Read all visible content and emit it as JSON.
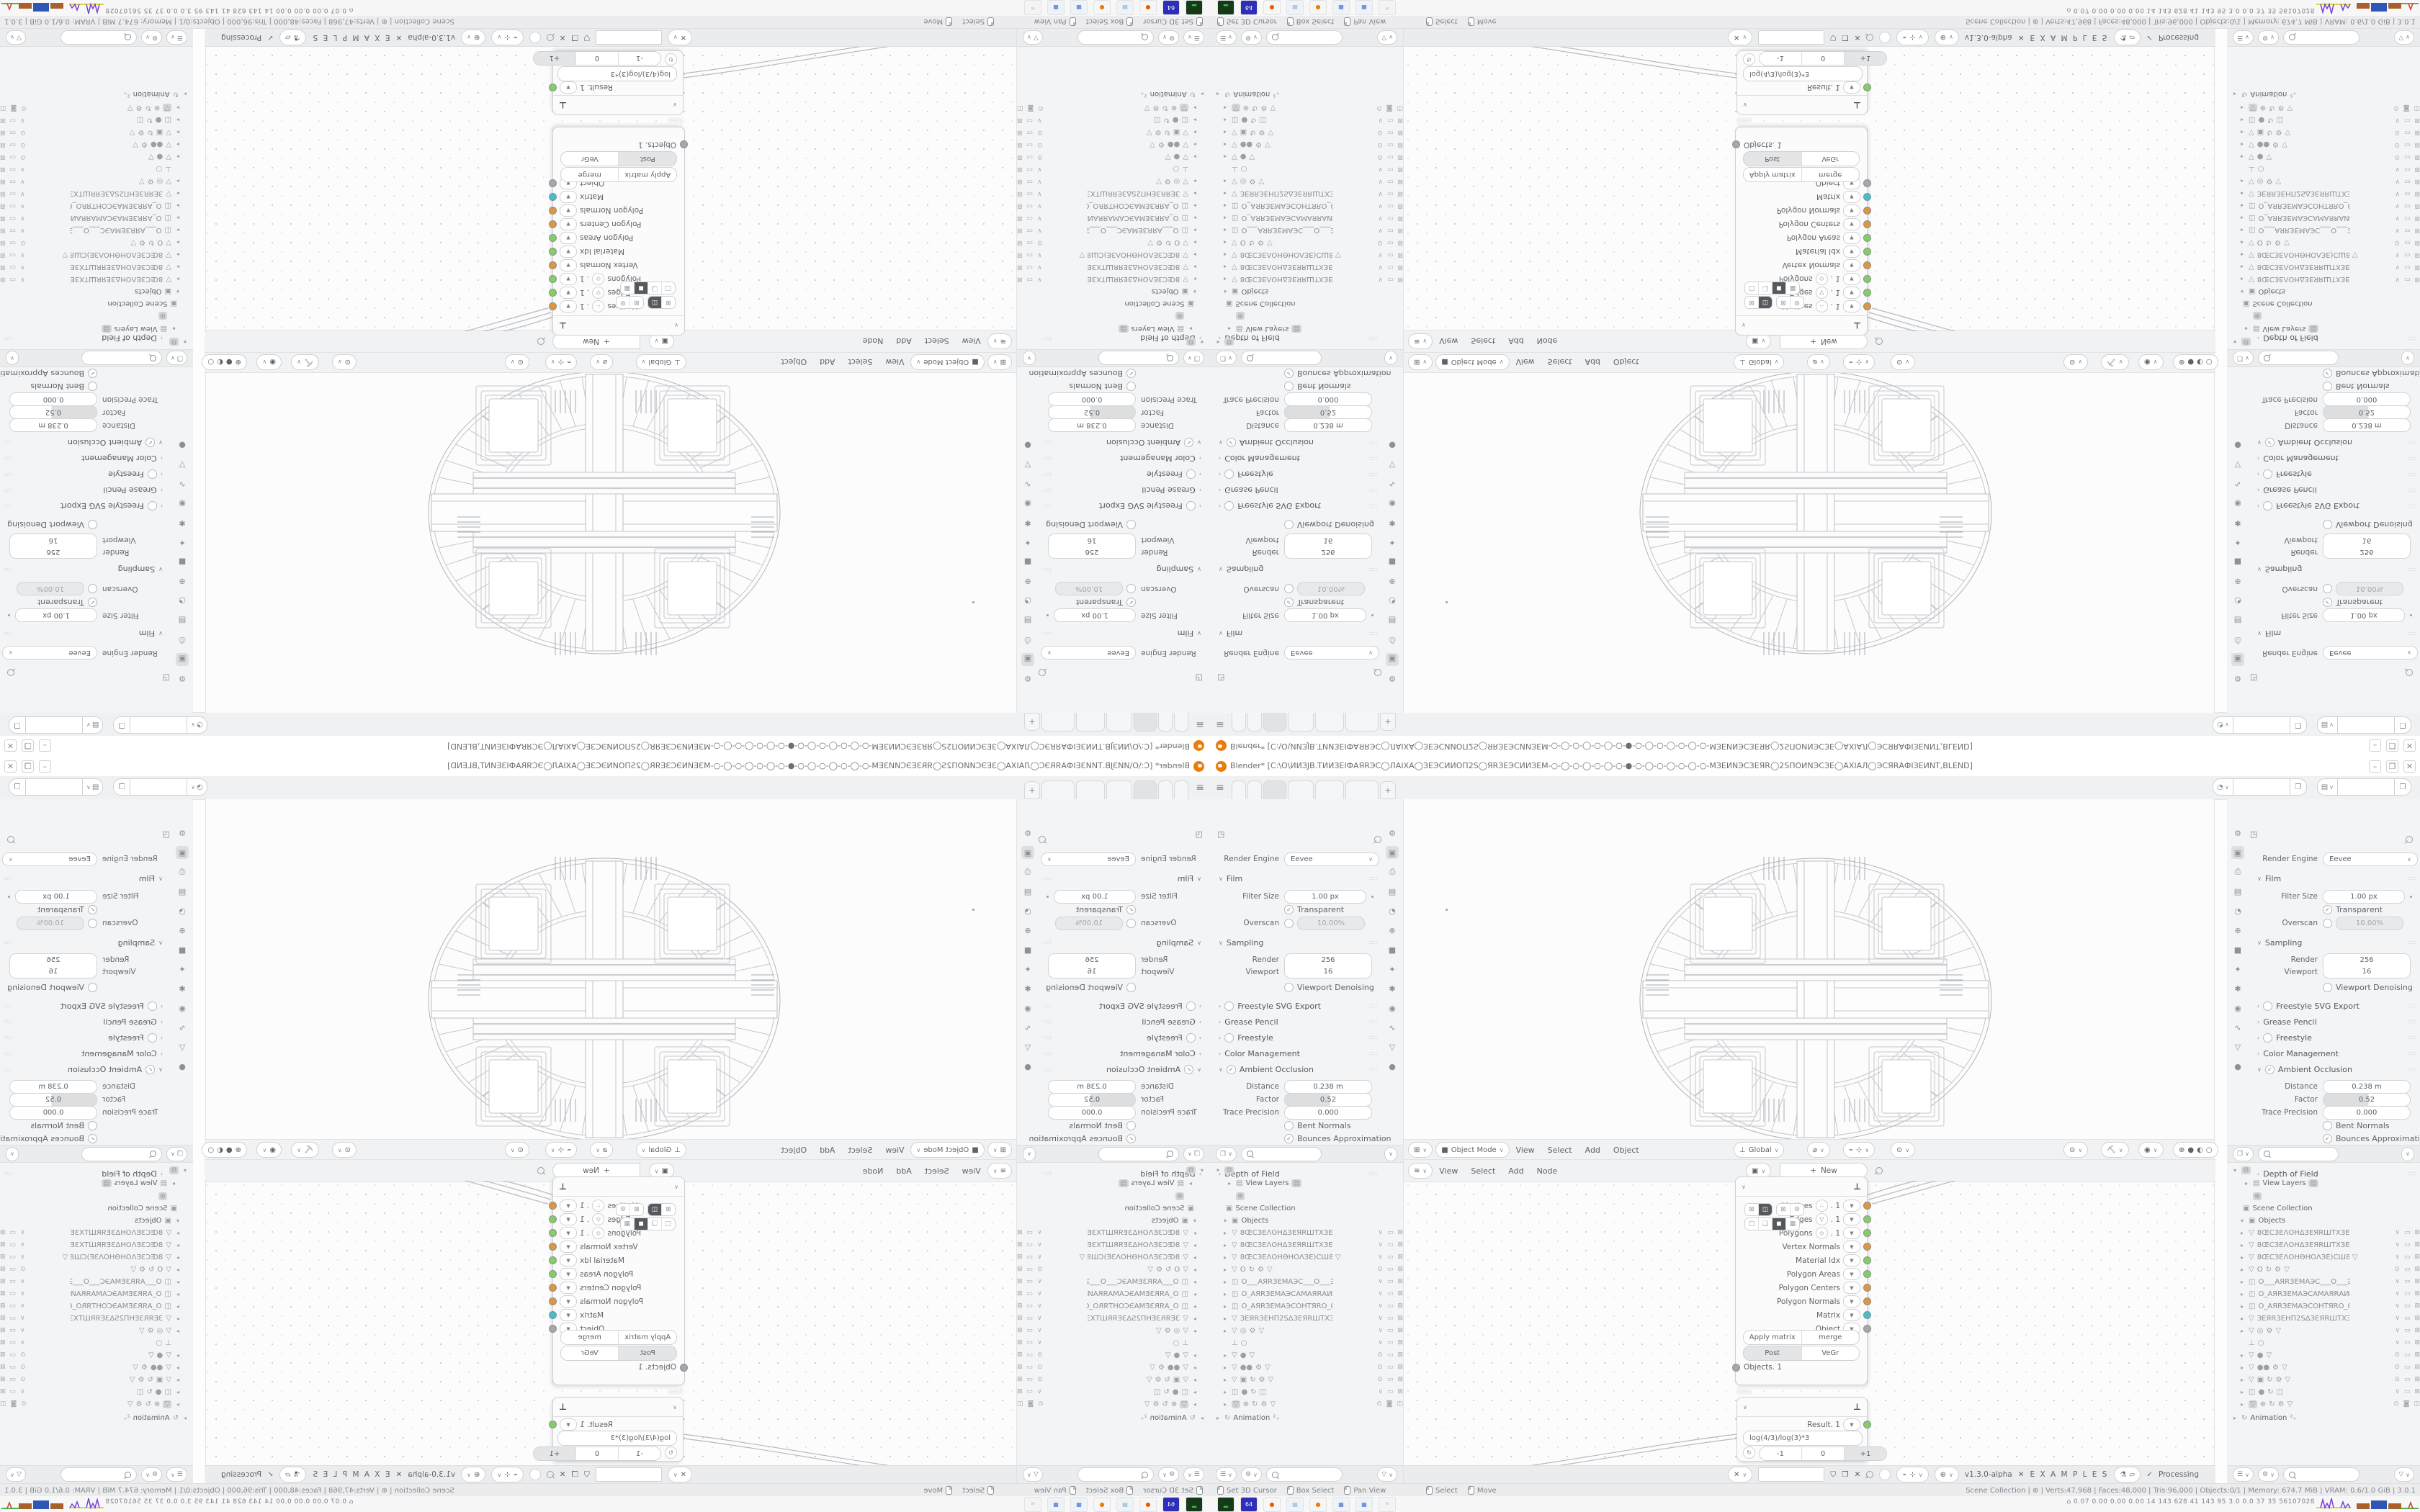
{
  "colors": {
    "socket_orange": "#e0963c",
    "socket_green": "#84cf63",
    "socket_cyan": "#3fc0cb",
    "socket_gray": "#a4a8ac",
    "accent_blender": "#e87d0d",
    "graph_yellow": "#d8d84a",
    "graph_purple": "#7a3fd8",
    "graph_brown": "#a9602a",
    "graph_blue": "#2d56b5",
    "graph_green": "#49b849",
    "graph_red": "#d03a2a"
  },
  "tile": {
    "title": "Blender* [C:\\O\\ИИЗЈВ.ТИИЗЕІФАЯRЭС◯ЛАІХА◯ЗЕЭСИИОП2S◯ЯRЗЕЭСИИЗЕМ-○-◯-○-◯-○-◯-○-●-○-◯-○-◯-○-◯-○-МЗЕИNЭСЗЕЯR◯2SПОИNЭСЗЕ◯AXIАЛ◯ЭСЯRАФІЗЕИNT,BLEND]",
    "winbtns": {
      "min": "–",
      "restore": "❐",
      "close": "✕"
    },
    "tabbar": {
      "burger": "≡",
      "plus": "+",
      "tabs": [
        {
          "w": 18
        },
        {
          "w": 18
        },
        {
          "w": 30,
          "active": true
        },
        {
          "w": 34
        },
        {
          "w": 38
        },
        {
          "w": 44
        }
      ]
    },
    "props": {
      "tab_icons": [
        "⚙",
        "▣",
        "⎙",
        "▤",
        "◔",
        "⊕",
        "■",
        "✦",
        "✱",
        "◉",
        "∿",
        "▽",
        "●"
      ],
      "active_tab_index": 1,
      "render_engine_label": "Render Engine",
      "render_engine_value": "Eevee",
      "film": "Film",
      "filter_size_label": "Filter Size",
      "filter_size_value": "1.00 px",
      "transparent": "Transparent",
      "overscan_label": "Overscan",
      "overscan_value": "10.00%",
      "sampling": "Sampling",
      "render_label": "Render",
      "render_value": "256",
      "viewport_label": "Viewport",
      "viewport_value": "16",
      "viewport_denoising": "Viewport Denoising",
      "freestyle_svg": "Freestyle SVG Export",
      "grease_pencil": "Grease Pencil",
      "freestyle": "Freestyle",
      "color_management": "Color Management",
      "ambient_occlusion": "Ambient Occlusion",
      "distance_label": "Distance",
      "distance_value": "0.238 m",
      "factor_label": "Factor",
      "factor_value": "0.52",
      "trace_label": "Trace Precision",
      "trace_value": "0.000",
      "bent_normals": "Bent Normals",
      "bounces": "Bounces Approximation",
      "bloom": "Bloom",
      "dof": "Depth of Field"
    },
    "outliner": {
      "view_layers": "View Layers",
      "scene_collection": "Scene Collection",
      "objects": "Objects",
      "animation": "Animation",
      "anim_badge": "²₊",
      "rows": [
        {
          "exp": "▸",
          "icon": "▽",
          "name": "8ŒCЗЕΛОНΔЗЕЯRШТХЗЕТОТЗЕХТІЅ",
          "extras": [],
          "right": [
            "∨",
            "▭",
            "⊠"
          ]
        },
        {
          "exp": "▸",
          "icon": "▽",
          "name": "8ŒCЗЕΛОНΔЗЕЯRШТХЗЕТОТЗЕХТІЅ",
          "extras": [],
          "right": [
            "∨",
            "▭",
            "⊠"
          ]
        },
        {
          "exp": "▸",
          "icon": "▽",
          "name": "8ŒCЗЕΛОНѲНОΛЗЕ)СШ8",
          "extras": [
            "▽"
          ],
          "right": [
            "∨",
            "▭",
            "⊠"
          ]
        },
        {
          "exp": "▸",
          "icon": "▽",
          "name": "O",
          "extras": [
            "↻",
            "⚙",
            "▽"
          ],
          "right": [
            "⊙",
            "▭",
            "⊠"
          ]
        },
        {
          "exp": "▸",
          "icon": "◫",
          "name": "О___АЯRЗЕМАЭС___О___ЭСАМЗЕ",
          "extras": [],
          "right": [
            "∨",
            "▭",
            "⊠"
          ]
        },
        {
          "exp": "▸",
          "icon": "◫",
          "name": "О_АЯRЗЕМАЭСАМАЯRАИNАП__О",
          "extras": [],
          "right": [
            "∨",
            "▭",
            "⊠"
          ]
        },
        {
          "exp": "▸",
          "icon": "◫",
          "name": "О_АЯRЗЕМАЭСОНТЯRО_О_ОЯRТН",
          "extras": [],
          "right": [
            "∨",
            "▭",
            "⊠"
          ]
        },
        {
          "exp": "▸",
          "icon": "▽",
          "name": "ЗЕЯRЗЕНП2SΔЗЕЯRШТХЗЕТОТЗЕХТІЕ",
          "extras": [],
          "right": [
            "∨",
            "▭",
            "⊠"
          ]
        },
        {
          "exp": "▸",
          "icon": "▽",
          "name": "",
          "extras": [
            "◎",
            "⚙",
            "▽"
          ],
          "right": [
            "∨",
            "▭",
            "⊠"
          ]
        },
        {
          "exp": "",
          "icon": "⊥",
          "name": "",
          "extras": [
            "○"
          ],
          "right": [
            "∨",
            "▭",
            "⊠"
          ]
        },
        {
          "exp": "▸",
          "icon": "▽",
          "name": "",
          "extras": [
            "●",
            "▽"
          ],
          "right": [
            "⊙",
            "▭",
            "⊠"
          ]
        },
        {
          "exp": "▸",
          "icon": "▽",
          "name": "",
          "extras": [
            "●●",
            "⚙",
            "▽"
          ],
          "right": [
            "⊙",
            "▭",
            "⊠"
          ]
        },
        {
          "exp": "▸",
          "icon": "▽",
          "name": "",
          "extras": [
            "▣",
            "↻",
            "⚙",
            "▽"
          ],
          "right": [
            "⊙",
            "▭",
            "⊠"
          ]
        },
        {
          "exp": "▸",
          "icon": "◫",
          "name": "",
          "extras": [
            "●",
            "↻",
            "◫"
          ],
          "right": [
            "∨",
            "▭",
            "⊠"
          ]
        },
        {
          "exp": "▸",
          "icon": "▽",
          "sel": true,
          "name": "",
          "extras": [
            "⊕",
            "↻",
            "⚙",
            "▽"
          ],
          "right": [
            "⊙",
            "◙",
            "◫"
          ]
        }
      ]
    },
    "outliner_header": {
      "search_placeholder": "",
      "filter": "▽"
    },
    "viewport_header": {
      "mode_icon": "■",
      "mode": "Object Mode",
      "menus": [
        "View",
        "Select",
        "Add",
        "Object"
      ],
      "orientation": "Global",
      "shading": [
        "⊕",
        "●",
        "◐",
        "○"
      ]
    },
    "node_editor_top": {
      "menus": [
        "View",
        "Select",
        "Add",
        "Node"
      ],
      "new_label": "New",
      "plus": "+"
    },
    "get_node": {
      "outputs": [
        {
          "label": "Vertices",
          "icon": "∴",
          "suffix": ". 1",
          "color": "#e0963c"
        },
        {
          "label": "Edges",
          "icon": "▽",
          "suffix": ". 1",
          "color": "#84cf63"
        },
        {
          "label": "Polygons",
          "icon": "◇",
          "suffix": ". 1",
          "color": "#84cf63"
        },
        {
          "label": "Vertex Normals",
          "color": "#e0963c"
        },
        {
          "label": "Material Idx",
          "color": "#84cf63"
        },
        {
          "label": "Polygon Areas",
          "color": "#84cf63"
        },
        {
          "label": "Polygon Centers",
          "color": "#e0963c"
        },
        {
          "label": "Polygon Normals",
          "color": "#e0963c"
        },
        {
          "label": "Matrix",
          "color": "#3fc0cb"
        },
        {
          "label": "Object",
          "color": "#a4a8ac"
        }
      ],
      "btn_row1": [
        "Apply matrix",
        "merge"
      ],
      "btn_row2": [
        "Post",
        "VeGr"
      ],
      "pressed": "Post",
      "input_socket": "Objects. 1",
      "time_badge": "0ms",
      "mini1": [
        "⊠",
        "◫"
      ],
      "mini2": [
        "⊠",
        "⚙"
      ],
      "mini3": [
        "□",
        "❏",
        "◼",
        "▦"
      ]
    },
    "result_node": {
      "label": "Result. 1",
      "formula": "log(4/3)/log(3)*3",
      "cycle": "↻",
      "steps": [
        "-1",
        "0",
        "+1"
      ],
      "active_step": "+1"
    },
    "node_editor_bottom": {
      "tree_icon": "✕",
      "version": "v1.3.0-alpha",
      "dna": "✕",
      "tree_name": "E X A M P L E S",
      "check": "✓",
      "processing": "Processing",
      "shield": "🛡",
      "copy": "❐",
      "close": "✕"
    },
    "status": {
      "hints_left": [
        {
          "label": "Set 3D Cursor"
        },
        {
          "label": "Box Select"
        },
        {
          "label": "Pan View"
        }
      ],
      "hints_mid": [
        {
          "label": "Select"
        },
        {
          "label": "Move"
        }
      ],
      "right_segments": [
        "Scene Collection",
        "⊕",
        "Verts:47,968",
        "Faces:48,000",
        "Tris:96,000",
        "Objects:0/1",
        "Memory: 674.7 MiB",
        "VRAM: 0.6/1.0 GiB",
        "3.0.1"
      ]
    },
    "taskbar": {
      "icons": [
        {
          "name": "terminal-icon",
          "bg": "#16391a",
          "glyph": "▂",
          "fg": "#39c239"
        },
        {
          "name": "floppy-64-icon",
          "bg": "#2e2eb8",
          "glyph": "64",
          "fg": "#ffffff"
        },
        {
          "name": "firefox-icon",
          "bg": "#f6f6f6",
          "glyph": "●",
          "fg": "#e66000"
        },
        {
          "name": "notepad-icon",
          "bg": "#eef3f8",
          "glyph": "▤",
          "fg": "#7aa7d0"
        },
        {
          "name": "blender-icon",
          "bg": "#f6f6f6",
          "glyph": "●",
          "fg": "#e87d0d"
        },
        {
          "name": "calculator-icon",
          "bg": "#eef3f8",
          "glyph": "▦",
          "fg": "#4a6fd0"
        },
        {
          "name": "calculator2-icon",
          "bg": "#eef3f8",
          "glyph": "▦",
          "fg": "#4a6fd0"
        },
        {
          "name": "map-faded-icon",
          "bg": "#f4f4f4",
          "glyph": "⚑",
          "fg": "#d5d7d9"
        }
      ],
      "sysmon": "⌂  0.07 0.00 0.00 0.00   14   143   628   41   143   95   3.0   0.0   37   35  56107028"
    }
  }
}
